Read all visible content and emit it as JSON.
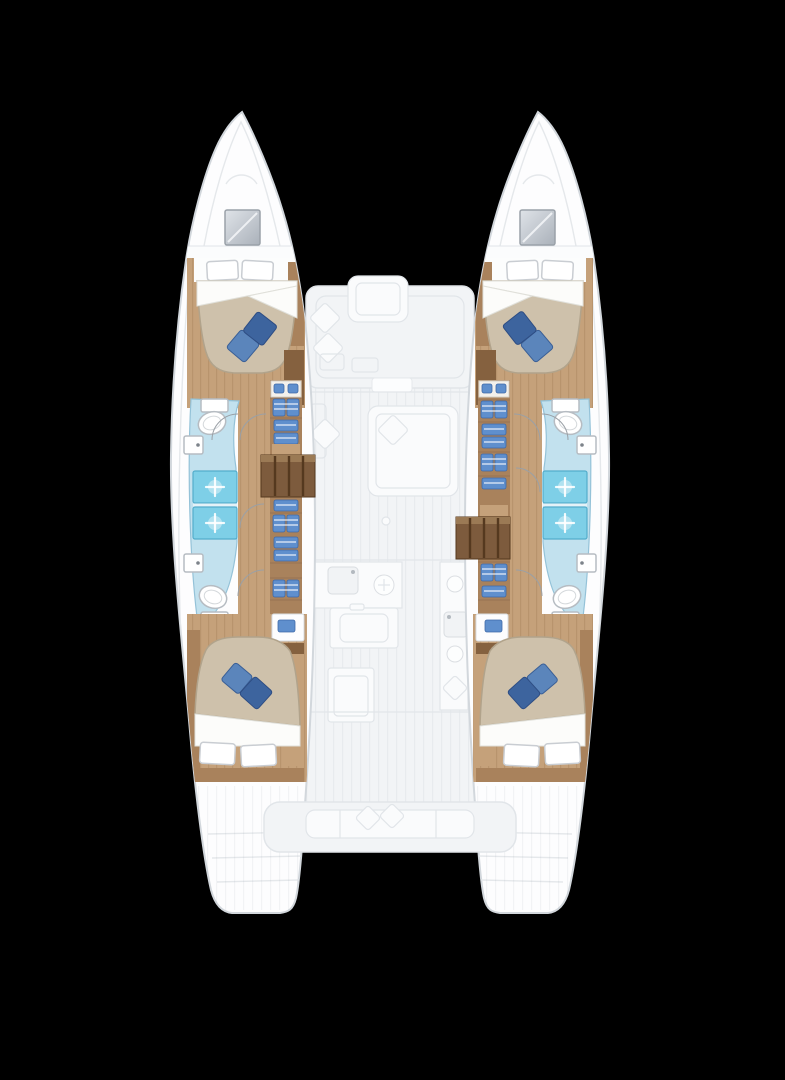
{
  "meta": {
    "description": "Catamaran yacht four-cabin lower-deck floor plan, bow up, on black background"
  },
  "colors": {
    "background": "#000000",
    "hull-fill": "#fdfdfe",
    "hull-outline": "#d2d7dc",
    "deck-fill": "#f2f4f6",
    "deck-item": "#fafbfc",
    "deck-outline": "#e1e5e9",
    "wood-floor": "#c5a17a",
    "wood-mid": "#a9825c",
    "wood-dark": "#85613f",
    "stairs-fill": "#7d5b3d",
    "stairs-slat": "#55391f",
    "bed-duvet": "#cec1ab",
    "bed-duvet-edge": "#b1a38b",
    "pillow-white": "#ffffff",
    "pillow-blue-light": "#5b85bb",
    "pillow-blue-dark": "#3d649e",
    "bath-floor": "#c2e1ee",
    "bath-outline": "#94c2d8",
    "shower-fill": "#7ecfe7",
    "shower-outline": "#53adcb",
    "fixture-fill": "#ffffff",
    "fixture-outline": "#b6bcc2",
    "drawer-blue": "#5f8fcd",
    "door-arc": "#9aa0a6"
  },
  "icons": {
    "toilet-icon": "tilted ellipse",
    "sink-icon": "rounded square with faucet dot",
    "shower-head-icon": "white sparkle cross on cyan tray",
    "stove-burner-icon": "circle",
    "drawer-icon": "blue bin with white stripe",
    "hanging-clothes-icon": "paired blue lockers with white rails",
    "bow-hatch-icon": "grey glazed square"
  },
  "inventory": {
    "double_cabins": 4,
    "bathrooms": 4,
    "showers": 4,
    "toilets": 4,
    "sinks": 4,
    "companionway_stairs": 2,
    "ghosted_spaces": [
      "forward cockpit",
      "saloon",
      "galley",
      "aft cockpit",
      "transom steps"
    ]
  }
}
